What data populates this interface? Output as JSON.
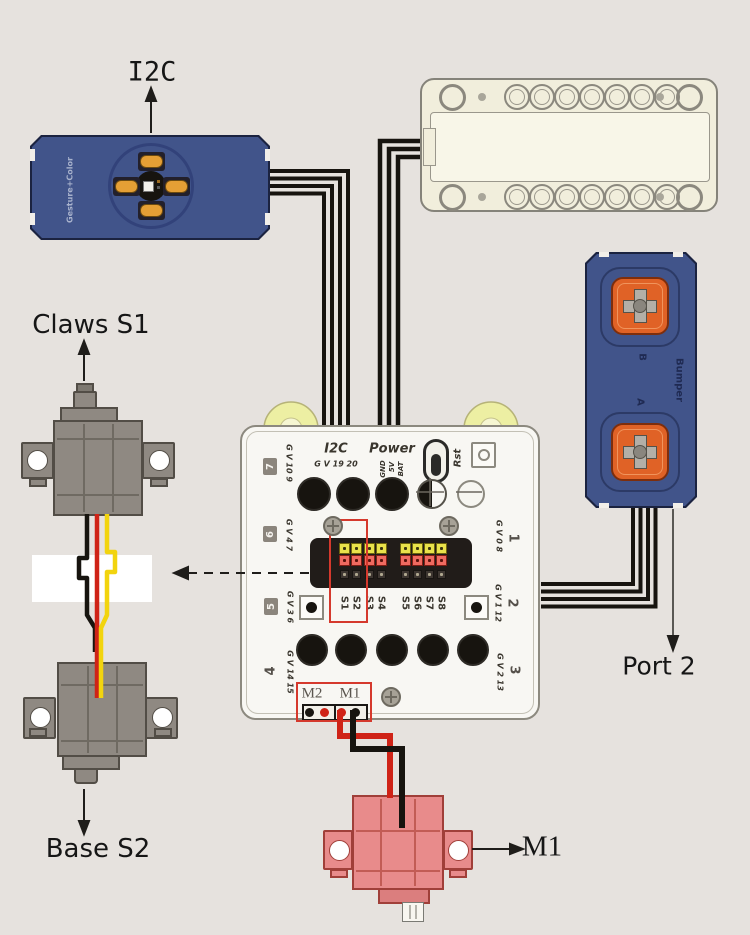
{
  "labels": {
    "i2c": "I2C",
    "claws": "Claws S1",
    "base": "Base S2",
    "port2": "Port 2",
    "m1": "M1"
  },
  "sensor": {
    "name": "Gesture+Color"
  },
  "bumper": {
    "name": "Bumper",
    "button_b": "B",
    "button_a": "A"
  },
  "board": {
    "i2c_label": "I2C",
    "i2c_pins": "G V 19 20",
    "power_label": "Power",
    "power_pins": [
      "GND",
      "5V",
      "BAT"
    ],
    "rst_label": "Rst",
    "ports_left": [
      {
        "n": "7",
        "pins": "G V 10 9"
      },
      {
        "n": "6",
        "pins": "G V 4 7"
      },
      {
        "n": "5",
        "pins": "G V 3 6"
      },
      {
        "n": "4",
        "pins": "G V 14 15"
      }
    ],
    "ports_right": [
      {
        "n": "1",
        "pins": "G V 0 8"
      },
      {
        "n": "2",
        "pins": "G V 1 12"
      },
      {
        "n": "3",
        "pins": "G V 2 13"
      }
    ],
    "servo_pins": [
      "S1",
      "S2",
      "S3",
      "S4",
      "S5",
      "S6",
      "S7",
      "S8"
    ],
    "motor_ports": [
      "M2",
      "M1"
    ]
  },
  "colors": {
    "background": "#e6e2de",
    "module_navy": "#41548a",
    "button_orange": "#e06226",
    "contact_orange": "#e59f35",
    "board_white": "#f8f7f3",
    "wheel_yellow": "#edefa3",
    "pin_yellow": "#e9e24b",
    "pin_red": "#ef6a60",
    "highlight_red": "#d5392d",
    "wire_red": "#cf2317",
    "wire_yellow": "#f2d40e",
    "wire_black": "#17140f",
    "servo_gray": "#8f8982",
    "motor_pink": "#e88b8b"
  }
}
